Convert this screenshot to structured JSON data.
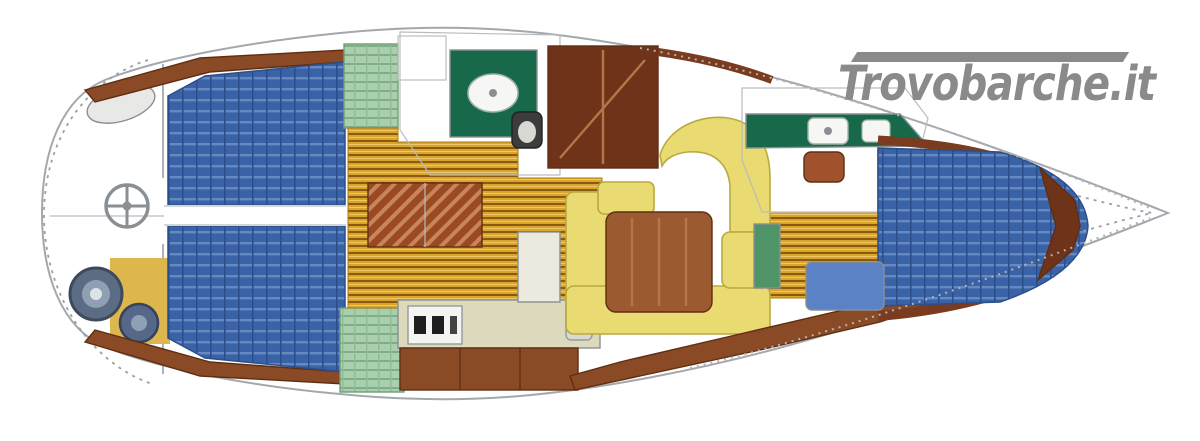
{
  "watermark": {
    "text": "Trovobarche.it",
    "color": "#8a8a8a"
  },
  "palette": {
    "hull_fill": "#ffffff",
    "hull_stroke": "#a3a8ad",
    "berth_blue": "#3a62a6",
    "berth_blue_light": "#6d8fc7",
    "bench_blue": "#5b82c4",
    "teak_gold": "#d9a52b",
    "teak_dark": "#8a5a12",
    "wood_brown": "#8a4a26",
    "wood_dark": "#6e3318",
    "table_wood": "#9c5a30",
    "settee_yellow": "#e9da72",
    "settee_border": "#b9aa40",
    "locker_green": "#aacfae",
    "vanity_green": "#17694a",
    "cabinet_green": "#4e9468",
    "counter_beige": "#ddd9bd",
    "counter_white": "#eceadf",
    "white_fixture": "#f4f4f2",
    "steel_grey": "#5b6c84",
    "steel_grey_small": "#56688a",
    "cockpit_tan": "#ddb64e",
    "toilet_brown": "#a0522d",
    "trim_orange": "#b06a3a",
    "stern_oval_fill": "#e8e8e6"
  },
  "regions": [
    {
      "name": "cockpit",
      "items": [
        "steering-wheel",
        "stern-locker",
        "winch-large",
        "winch-small",
        "helm-bench"
      ]
    },
    {
      "name": "aft-cabin-port",
      "items": [
        "double-berth",
        "wardrobe"
      ]
    },
    {
      "name": "aft-cabin-starboard",
      "items": [
        "double-berth",
        "wardrobe"
      ]
    },
    {
      "name": "aft-head",
      "items": [
        "sink-vanity",
        "toilet",
        "shower-floor"
      ]
    },
    {
      "name": "galley",
      "items": [
        "stove",
        "sink",
        "counter",
        "lower-cabinet"
      ]
    },
    {
      "name": "saloon",
      "items": [
        "u-settee",
        "dining-table",
        "nav-wardrobe",
        "companionway-steps",
        "side-cabinet"
      ]
    },
    {
      "name": "forward-head",
      "items": [
        "sink-vanity",
        "toilet",
        "locker"
      ]
    },
    {
      "name": "forward-cabin",
      "items": [
        "v-berth",
        "seat",
        "corridor",
        "bow-locker"
      ]
    }
  ]
}
